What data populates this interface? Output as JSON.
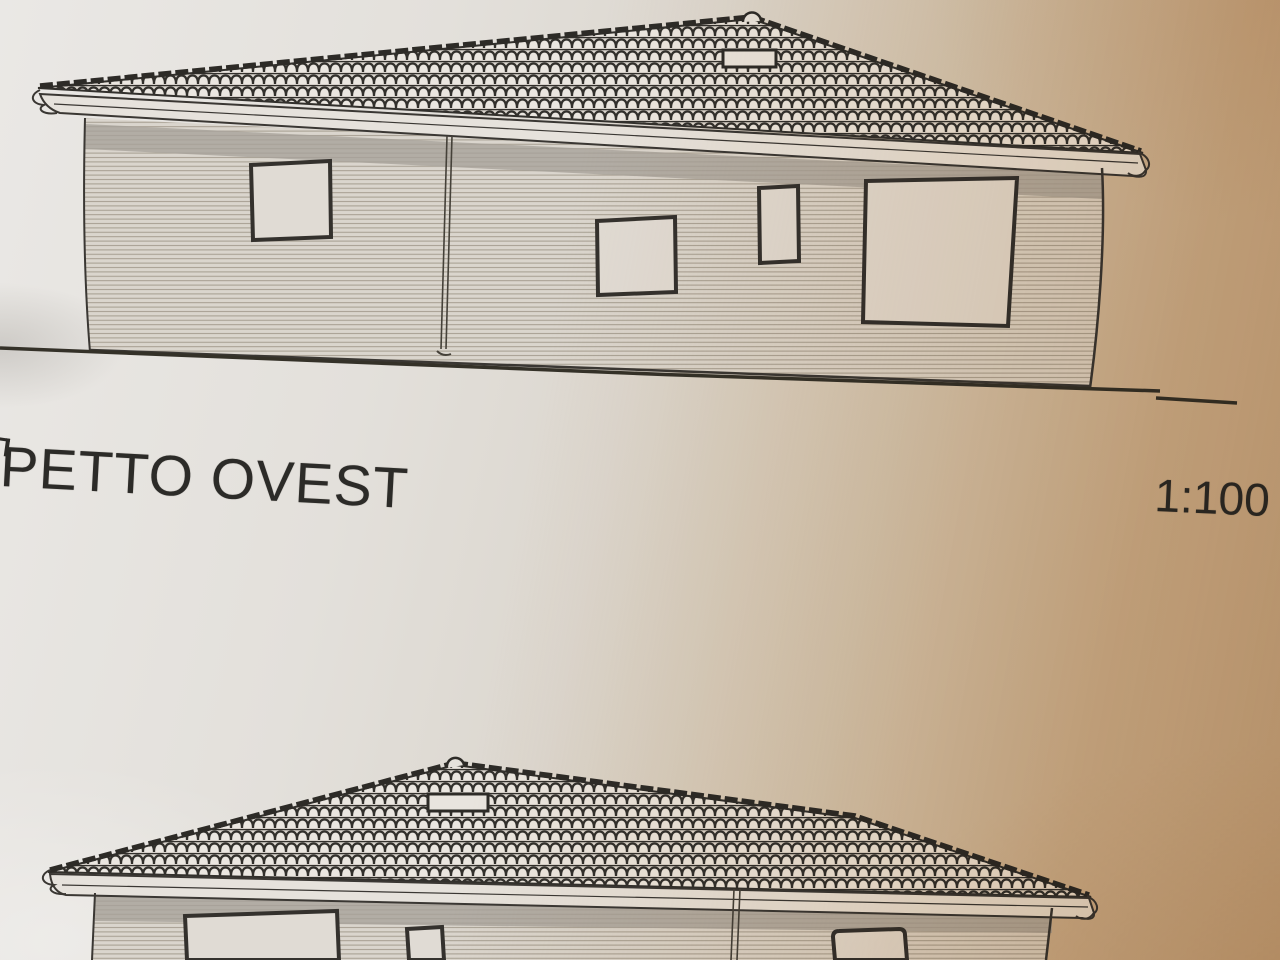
{
  "photo": {
    "paper_color_left": "#e6e3df",
    "paper_color_right": "#c7ae8e",
    "ink_color": "#33302c",
    "shadow_band_color": "#a7a19a"
  },
  "annotations": {
    "elevation_title": "PETTO OVEST",
    "scale_label": "1:100"
  },
  "top_elevation": {
    "window_count": 4,
    "features": [
      "hip-tiled-roof",
      "ridge-finial",
      "roof-vent",
      "gutter-fascia",
      "downspout",
      "shadow-band",
      "ground-line"
    ]
  },
  "bottom_elevation": {
    "window_count": 3,
    "features": [
      "hip-tiled-roof",
      "ridge-finial",
      "roof-vent",
      "gutter-fascia",
      "downspout",
      "shadow-band"
    ],
    "cut_off_at_bottom": true
  }
}
